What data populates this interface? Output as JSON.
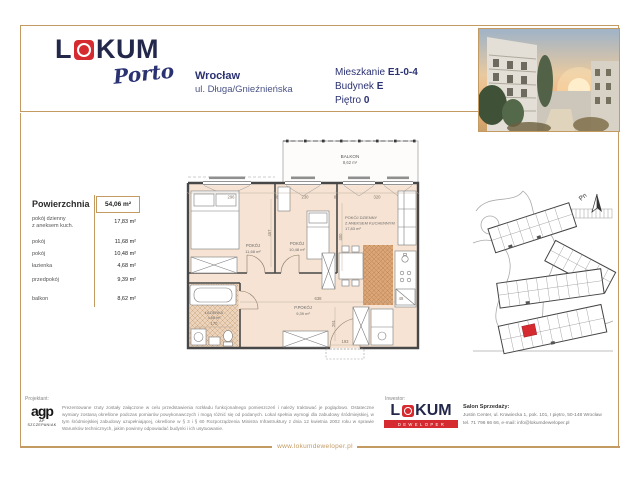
{
  "colors": {
    "gold": "#C49A63",
    "navy": "#2B3272",
    "navy_dark": "#23284B",
    "red": "#D52B30",
    "plan_fill": "#F6E3D3",
    "kitchen_hatch": "#C98F63"
  },
  "header": {
    "brand": {
      "part1": "L",
      "part2": "KUM",
      "script": "Porto"
    },
    "city": "Wrocław",
    "street": "ul. Długa/Gnieźnieńska",
    "fields": [
      {
        "label": "Mieszkanie ",
        "value": "E1-0-4"
      },
      {
        "label": "Budynek ",
        "value": "E"
      },
      {
        "label": "Piętro ",
        "value": "0"
      }
    ]
  },
  "area_table": {
    "title": "Powierzchnia",
    "total": "54,06 m²",
    "rows": [
      {
        "label": "pokój dzienny\nz aneksem kuch.",
        "value": "17,83 m²"
      },
      {
        "label": "pokój",
        "value": "11,68 m²"
      },
      {
        "label": "pokój",
        "value": "10,48 m²"
      },
      {
        "label": "łazienka",
        "value": "4,68 m²"
      },
      {
        "label": "przedpokój",
        "value": "9,39 m²"
      },
      {
        "label": "balkon",
        "value": "8,62 m²"
      }
    ]
  },
  "plan": {
    "balcony": {
      "name": "BALKON",
      "area": "8,62 m²"
    },
    "rooms": [
      {
        "name": "POKÓJ",
        "area": "11,68 m²"
      },
      {
        "name": "POKÓJ",
        "area": "10,48 m²"
      },
      {
        "name": "POKÓJ DZIENNY",
        "name2": "Z ANEKSEM KUCHENNYM",
        "area": "17,83 m²"
      },
      {
        "name": "ŁAZIENKA",
        "area": "4,68 m²"
      },
      {
        "name": "P.POKÓJ",
        "area": "9,39 m²"
      }
    ],
    "dims": [
      "296",
      "8",
      "230",
      "8",
      "320",
      "457",
      "400",
      "638",
      "48",
      "261",
      "193",
      "170"
    ]
  },
  "site_map": {
    "north": "Pn"
  },
  "footer": {
    "projektant_label": "Projektant:",
    "architect": {
      "logo": "agp",
      "name": "AP SZCZEPANIAK"
    },
    "disclaimer": "Prezentowane rzuty zostały załączone w celu przedstawienia rozkładu funkcjonalnego pomieszczeń i należy traktować je poglądowo. Ostateczne wymiary zostaną określone podczas pomiarów powykonawczych i mogą różnić się od podanych. Lokal spełnia wymogi dla zabudowy śródmiejskiej, w tym śródmiejskiej zabudowy uzupełniającej, określone w § 3 i § 60 Rozporządzenia Ministra Infrastruktury z dnia 12 kwietnia 2002 roku w sprawie Warunków technicznych, jakim powinny odpowiadać budynki i ich usytuowanie.",
    "inwestor_label": "Inwestor:",
    "developer": {
      "part1": "L",
      "part2": "KUM",
      "band": "DEWELOPER"
    },
    "salon": {
      "title": "Salon Sprzedaży:",
      "address": "Justin Center, ul. Krawiecka 1, pok. 101, I piętro, 50-148 Wrocław",
      "contact": "tel. 71 796 66 66, e-mail: info@lokumdeweloper.pl"
    },
    "website": "www.lokumdeweloper.pl"
  }
}
